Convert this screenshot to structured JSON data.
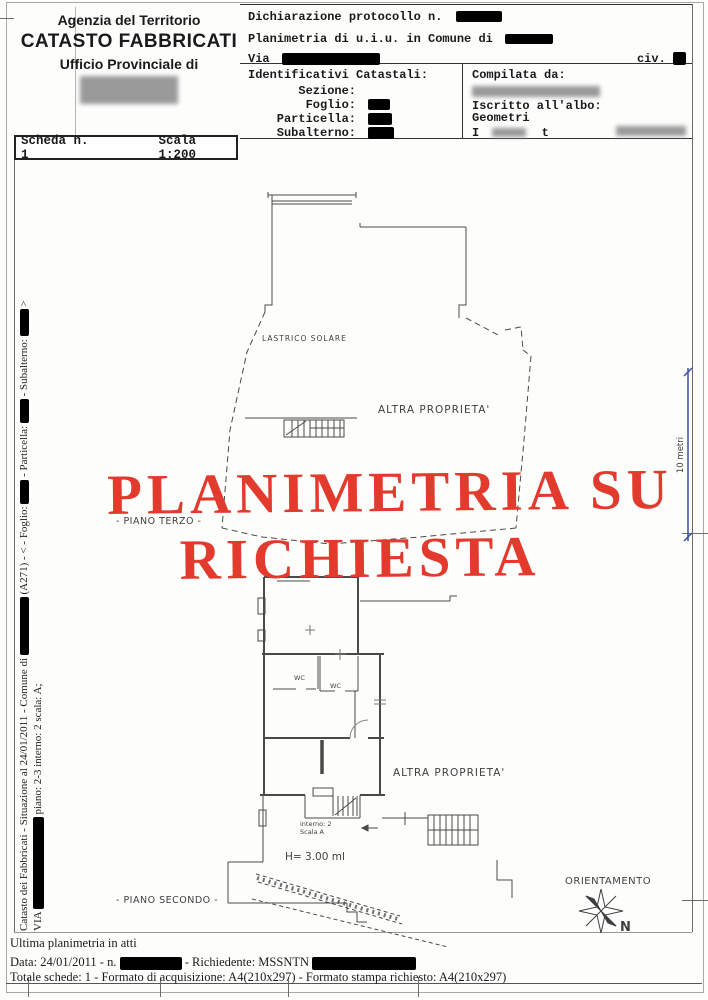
{
  "header": {
    "agency": {
      "line1": "Agenzia del Territorio",
      "line2": "CATASTO FABBRICATI",
      "line3": "Ufficio Provinciale di"
    },
    "declaration": {
      "protocol_label": "Dichiarazione protocollo n.",
      "planimetria_label": "Planimetria di u.i.u. in Comune di",
      "via_label": "Via",
      "civ_label": "civ."
    },
    "identificativi": {
      "title": "Identificativi Catastali:",
      "sezione_label": "Sezione:",
      "foglio_label": "Foglio:",
      "particella_label": "Particella:",
      "subalterno_label": "Subalterno:"
    },
    "compilata": {
      "title": "Compilata da:",
      "albo_line1": "Iscritto all'albo:",
      "albo_line2": "Geometri",
      "partial_left": "I",
      "partial_right": "t"
    },
    "scheda": {
      "scheda_label": "Scheda n. 1",
      "scala_label": "Scala 1:200"
    }
  },
  "watermark": {
    "line1": "PLANIMETRIA SU",
    "line2": "RICHIESTA",
    "color": "#e23b2e"
  },
  "plan": {
    "upper": {
      "lastrico_label": "LASTRICO SOLARE",
      "altra_proprieta_label": "ALTRA PROPRIETA'",
      "piano_label": "- PIANO TERZO -"
    },
    "lower": {
      "wc1_label": "WC",
      "wc2_label": "WC",
      "altra_proprieta_label": "ALTRA PROPRIETA'",
      "interno_label": "interno: 2",
      "scala_label": "Scala A",
      "height_label": "H= 3.00 ml",
      "piano_label": "- PIANO SECONDO -"
    },
    "dimension": {
      "label": "10 metri",
      "line_color": "#3a4fa5"
    },
    "compass": {
      "title": "ORIENTAMENTO",
      "north_label": "N"
    }
  },
  "sidebar": {
    "line1_p1": "Catasto dei Fabbricati - Situazione al 24/01/2011 - Comune di ",
    "line1_p2": " (A271) - < - Foglio: ",
    "line1_p3": " - Particella: ",
    "line1_p4": " - Subalterno: ",
    "line1_p5": " >",
    "line2_p1": "VIA ",
    "line2_p2": " piano: 2-3 interno: 2 scala: A;"
  },
  "footer": {
    "line1": "Ultima planimetria in atti",
    "line2_p1": "Data: 24/01/2011 - n.",
    "line2_p2": "- Richiedente: MSSNTN",
    "line3": "Totale schede: 1 - Formato di acquisizione: A4(210x297) - Formato stampa richiesto: A4(210x297)"
  }
}
